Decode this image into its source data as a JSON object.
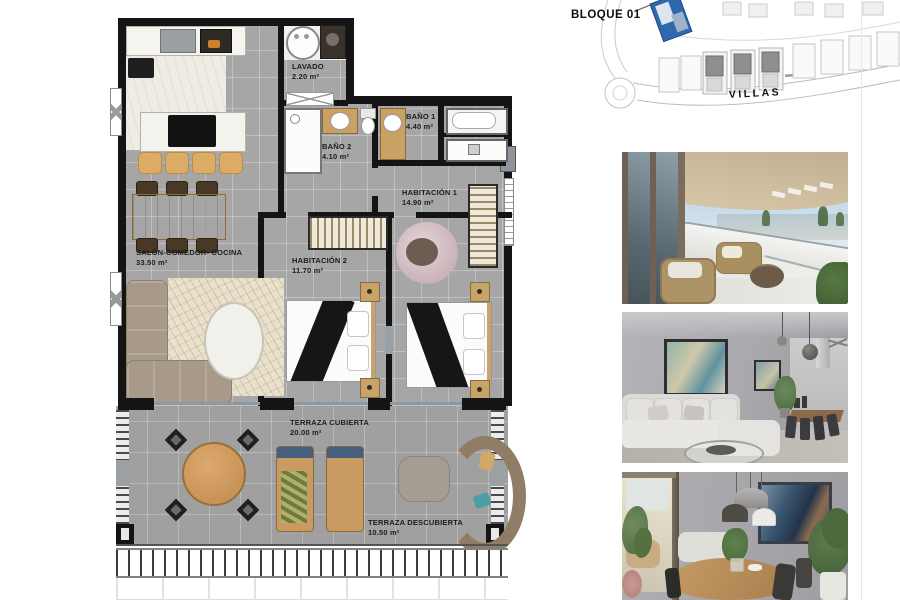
{
  "floor_plan": {
    "rooms": [
      {
        "name": "LAVADO",
        "area": "2.20 m²"
      },
      {
        "name": "BAÑO 2",
        "area": "4.10 m²"
      },
      {
        "name": "BAÑO 1",
        "area": "4.40 m²"
      },
      {
        "name": "HABITACIÓN 1",
        "area": "14.90 m²"
      },
      {
        "name": "HABITACIÓN 2",
        "area": "11.70 m²"
      },
      {
        "name": "SALÓN-COMEDOR- COCINA",
        "area": "33.50 m²"
      },
      {
        "name": "TERRAZA CUBIERTA",
        "area": "20.00 m²"
      },
      {
        "name": "TERRAZA DESCUBIERTA",
        "area": "10.50 m²"
      }
    ]
  },
  "site_plan": {
    "block_label": "BLOQUE 01",
    "street_label": "VILLAS",
    "block_highlight_color": "#2e68ae"
  },
  "colors": {
    "wall": "#141414",
    "floor_gray": "#a6a6a6"
  }
}
